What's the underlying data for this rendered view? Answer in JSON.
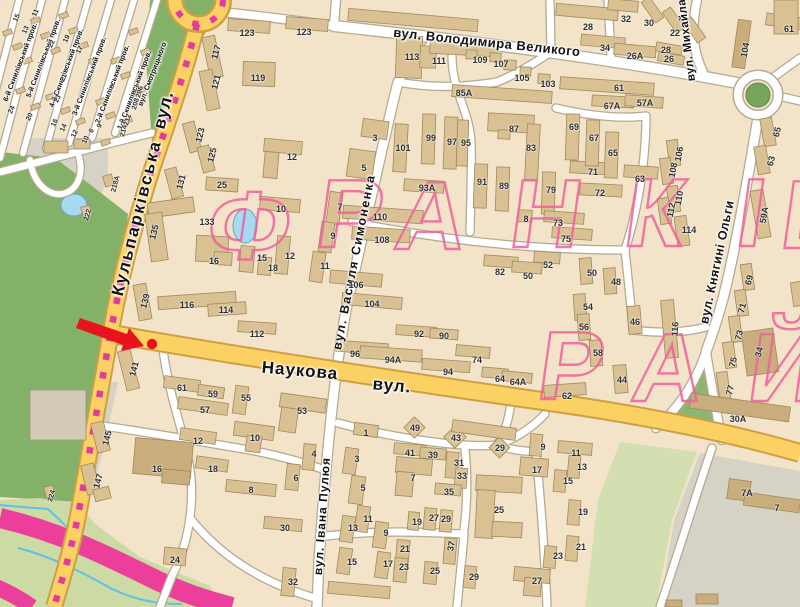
{
  "map": {
    "colors": {
      "road_yellow": "#fcd163",
      "road_yellow_casing": "#cf9f45",
      "tram_magenta": "#e23a9e",
      "district_pink": "#f0609c",
      "marker_red": "#e8131b",
      "park_green": "#83b168",
      "highway_pink": "#ec3f9c"
    },
    "watermark": {
      "letters": [
        {
          "ch": "Ф",
          "x": 245,
          "y": 259
        },
        {
          "ch": "Р",
          "x": 346,
          "y": 247
        },
        {
          "ch": "А",
          "x": 427,
          "y": 249
        },
        {
          "ch": "Н",
          "x": 542,
          "y": 247
        },
        {
          "ch": "К",
          "x": 651,
          "y": 246
        },
        {
          "ch": "І",
          "x": 747,
          "y": 246
        },
        {
          "ch": "В",
          "x": 813,
          "y": 248
        },
        {
          "ch": "Р",
          "x": 567,
          "y": 399
        },
        {
          "ch": "А",
          "x": 664,
          "y": 401
        },
        {
          "ch": "Й",
          "x": 780,
          "y": 401
        }
      ]
    },
    "marker": {
      "color": "#e8131b",
      "type": "arrow-with-dot"
    },
    "streets": [
      {
        "name": "вул. Володимира Великого",
        "x": 487,
        "y": 42,
        "r": 6,
        "s": 13,
        "ls": 0.5
      },
      {
        "name": "Кульпарківська",
        "x": 137,
        "y": 218,
        "r": -76,
        "s": 17,
        "ls": 2
      },
      {
        "name": "вул.",
        "x": 164,
        "y": 110,
        "r": -76,
        "s": 17,
        "ls": 1
      },
      {
        "name": "Наукова",
        "x": 300,
        "y": 371,
        "r": 5,
        "s": 17,
        "ls": 1
      },
      {
        "name": "вул.",
        "x": 392,
        "y": 386,
        "r": 5,
        "s": 17,
        "ls": 1
      },
      {
        "name": "вул. Василя Симоненка",
        "x": 354,
        "y": 262,
        "r": -79,
        "s": 12.5,
        "ls": 1.5
      },
      {
        "name": "вул. Івана Пулюя",
        "x": 322,
        "y": 516,
        "r": -86,
        "s": 12,
        "ls": 1
      },
      {
        "name": "вул. Михайла",
        "x": 687,
        "y": 40,
        "r": -97,
        "s": 11.5,
        "ls": 0.5
      },
      {
        "name": "вул. Княгині Ольги",
        "x": 717,
        "y": 262,
        "r": -78,
        "s": 12.5,
        "ls": 0.5
      },
      {
        "name": "6-й Скнилівський пров.",
        "x": 20,
        "y": 62,
        "r": -69,
        "s": 7.2,
        "ls": 0
      },
      {
        "name": "5-й Скнилівський пров.",
        "x": 43,
        "y": 58,
        "r": -69,
        "s": 7.2,
        "ls": 0
      },
      {
        "name": "4-й Скнилівський пров.",
        "x": 66,
        "y": 68,
        "r": -69,
        "s": 7.2,
        "ls": 0
      },
      {
        "name": "3-й Скнилівський пров.",
        "x": 89,
        "y": 76,
        "r": -69,
        "s": 7.2,
        "ls": 0
      },
      {
        "name": "2-й Скнилівський пров.",
        "x": 112,
        "y": 84,
        "r": -69,
        "s": 7.2,
        "ls": 0
      },
      {
        "name": "1-й Скнилівський пров.",
        "x": 134,
        "y": 90,
        "r": -69,
        "s": 7.2,
        "ls": 0
      },
      {
        "name": "вул. Смотрицького",
        "x": 152,
        "y": 74,
        "r": -69,
        "s": 7.2,
        "ls": 0
      }
    ],
    "numbers": [
      {
        "t": "113",
        "x": 412,
        "y": 57
      },
      {
        "t": "111",
        "x": 439,
        "y": 61
      },
      {
        "t": "109",
        "x": 480,
        "y": 60
      },
      {
        "t": "107",
        "x": 501,
        "y": 64
      },
      {
        "t": "105",
        "x": 522,
        "y": 78
      },
      {
        "t": "103",
        "x": 548,
        "y": 84
      },
      {
        "t": "28",
        "x": 588,
        "y": 27
      },
      {
        "t": "32",
        "x": 626,
        "y": 19
      },
      {
        "t": "34",
        "x": 605,
        "y": 48
      },
      {
        "t": "26А",
        "x": 635,
        "y": 56
      },
      {
        "t": "30",
        "x": 649,
        "y": 23
      },
      {
        "t": "22",
        "x": 675,
        "y": 33
      },
      {
        "t": "28",
        "x": 666,
        "y": 50
      },
      {
        "t": "26",
        "x": 669,
        "y": 59
      },
      {
        "t": "104",
        "x": 745,
        "y": 50,
        "r": -80
      },
      {
        "t": "61",
        "x": 789,
        "y": 29
      },
      {
        "t": "65",
        "x": 777,
        "y": 132,
        "r": -75
      },
      {
        "t": "63",
        "x": 771,
        "y": 161,
        "r": -75
      },
      {
        "t": "85А",
        "x": 464,
        "y": 93
      },
      {
        "t": "61",
        "x": 619,
        "y": 88
      },
      {
        "t": "67А",
        "x": 612,
        "y": 106
      },
      {
        "t": "57А",
        "x": 645,
        "y": 103
      },
      {
        "t": "69",
        "x": 574,
        "y": 127
      },
      {
        "t": "67",
        "x": 594,
        "y": 138
      },
      {
        "t": "65",
        "x": 613,
        "y": 153
      },
      {
        "t": "71",
        "x": 593,
        "y": 172
      },
      {
        "t": "72",
        "x": 600,
        "y": 193
      },
      {
        "t": "79",
        "x": 551,
        "y": 190
      },
      {
        "t": "89",
        "x": 504,
        "y": 186
      },
      {
        "t": "91",
        "x": 482,
        "y": 182
      },
      {
        "t": "83",
        "x": 531,
        "y": 148
      },
      {
        "t": "87",
        "x": 514,
        "y": 129
      },
      {
        "t": "95",
        "x": 466,
        "y": 143
      },
      {
        "t": "97",
        "x": 452,
        "y": 142
      },
      {
        "t": "99",
        "x": 431,
        "y": 138
      },
      {
        "t": "101",
        "x": 403,
        "y": 148
      },
      {
        "t": "93А",
        "x": 427,
        "y": 188
      },
      {
        "t": "8",
        "x": 526,
        "y": 219
      },
      {
        "t": "117",
        "x": 216,
        "y": 52,
        "r": -75
      },
      {
        "t": "119",
        "x": 258,
        "y": 78
      },
      {
        "t": "121",
        "x": 216,
        "y": 82,
        "r": -75
      },
      {
        "t": "123",
        "x": 247,
        "y": 33
      },
      {
        "t": "123",
        "x": 304,
        "y": 32
      },
      {
        "t": "123",
        "x": 200,
        "y": 135,
        "r": -75
      },
      {
        "t": "125",
        "x": 212,
        "y": 155,
        "r": -75
      },
      {
        "t": "131",
        "x": 181,
        "y": 182,
        "r": -75
      },
      {
        "t": "135",
        "x": 154,
        "y": 232,
        "r": -75
      },
      {
        "t": "16",
        "x": 214,
        "y": 261
      },
      {
        "t": "133",
        "x": 207,
        "y": 222
      },
      {
        "t": "139",
        "x": 145,
        "y": 301,
        "r": -75
      },
      {
        "t": "116",
        "x": 187,
        "y": 305
      },
      {
        "t": "114",
        "x": 226,
        "y": 310
      },
      {
        "t": "206",
        "x": 140,
        "y": 92,
        "r": -75,
        "s": 7
      },
      {
        "t": "208",
        "x": 136,
        "y": 104,
        "r": -75,
        "s": 7
      },
      {
        "t": "212",
        "x": 128,
        "y": 120,
        "r": -75,
        "s": 7
      },
      {
        "t": "214",
        "x": 124,
        "y": 131,
        "r": -75,
        "s": 7
      },
      {
        "t": "218А",
        "x": 116,
        "y": 184,
        "r": -75,
        "s": 7
      },
      {
        "t": "222",
        "x": 88,
        "y": 215,
        "r": -75,
        "s": 7
      },
      {
        "t": "224",
        "x": 52,
        "y": 496,
        "r": -75,
        "s": 7
      },
      {
        "t": "25",
        "x": 222,
        "y": 185
      },
      {
        "t": "12",
        "x": 292,
        "y": 157
      },
      {
        "t": "10",
        "x": 281,
        "y": 209
      },
      {
        "t": "12",
        "x": 290,
        "y": 256
      },
      {
        "t": "15",
        "x": 262,
        "y": 258
      },
      {
        "t": "18",
        "x": 273,
        "y": 268
      },
      {
        "t": "3",
        "x": 375,
        "y": 138
      },
      {
        "t": "5",
        "x": 364,
        "y": 168
      },
      {
        "t": "7",
        "x": 340,
        "y": 207
      },
      {
        "t": "9",
        "x": 333,
        "y": 236
      },
      {
        "t": "11",
        "x": 325,
        "y": 266
      },
      {
        "t": "110",
        "x": 380,
        "y": 217
      },
      {
        "t": "108",
        "x": 382,
        "y": 240
      },
      {
        "t": "106",
        "x": 356,
        "y": 285
      },
      {
        "t": "104",
        "x": 372,
        "y": 304
      },
      {
        "t": "112",
        "x": 257,
        "y": 334
      },
      {
        "t": "96",
        "x": 355,
        "y": 354
      },
      {
        "t": "94А",
        "x": 393,
        "y": 360
      },
      {
        "t": "94",
        "x": 448,
        "y": 372
      },
      {
        "t": "92",
        "x": 419,
        "y": 334
      },
      {
        "t": "90",
        "x": 444,
        "y": 336
      },
      {
        "t": "74",
        "x": 477,
        "y": 360
      },
      {
        "t": "82",
        "x": 500,
        "y": 272
      },
      {
        "t": "52",
        "x": 548,
        "y": 265
      },
      {
        "t": "50",
        "x": 528,
        "y": 276
      },
      {
        "t": "64",
        "x": 500,
        "y": 379
      },
      {
        "t": "64А",
        "x": 518,
        "y": 382
      },
      {
        "t": "62",
        "x": 567,
        "y": 396
      },
      {
        "t": "63",
        "x": 640,
        "y": 179
      },
      {
        "t": "106",
        "x": 679,
        "y": 154,
        "r": -80
      },
      {
        "t": "108",
        "x": 673,
        "y": 170,
        "r": -80
      },
      {
        "t": "110",
        "x": 679,
        "y": 198,
        "r": -80
      },
      {
        "t": "112",
        "x": 671,
        "y": 210,
        "r": -80
      },
      {
        "t": "114",
        "x": 689,
        "y": 230
      },
      {
        "t": "59А",
        "x": 764,
        "y": 215,
        "r": -80
      },
      {
        "t": "50",
        "x": 592,
        "y": 273
      },
      {
        "t": "48",
        "x": 616,
        "y": 282
      },
      {
        "t": "54",
        "x": 588,
        "y": 307
      },
      {
        "t": "56",
        "x": 584,
        "y": 327
      },
      {
        "t": "58",
        "x": 598,
        "y": 353
      },
      {
        "t": "46",
        "x": 635,
        "y": 322
      },
      {
        "t": "44",
        "x": 622,
        "y": 380
      },
      {
        "t": "116",
        "x": 675,
        "y": 329,
        "r": -85
      },
      {
        "t": "73",
        "x": 558,
        "y": 223
      },
      {
        "t": "75",
        "x": 566,
        "y": 239
      },
      {
        "t": "69",
        "x": 749,
        "y": 280,
        "r": -75
      },
      {
        "t": "71",
        "x": 742,
        "y": 308,
        "r": -75
      },
      {
        "t": "73",
        "x": 739,
        "y": 335,
        "r": -75
      },
      {
        "t": "75",
        "x": 733,
        "y": 362,
        "r": -75
      },
      {
        "t": "77",
        "x": 730,
        "y": 390,
        "r": -75
      },
      {
        "t": "34",
        "x": 759,
        "y": 352,
        "r": -75
      },
      {
        "t": "30А",
        "x": 738,
        "y": 419
      },
      {
        "t": "7А",
        "x": 747,
        "y": 493
      },
      {
        "t": "7",
        "x": 777,
        "y": 508
      },
      {
        "t": "141",
        "x": 134,
        "y": 369,
        "r": -75
      },
      {
        "t": "145",
        "x": 107,
        "y": 438,
        "r": -75
      },
      {
        "t": "147",
        "x": 98,
        "y": 481,
        "r": -75
      },
      {
        "t": "61",
        "x": 182,
        "y": 388
      },
      {
        "t": "59",
        "x": 213,
        "y": 394
      },
      {
        "t": "57",
        "x": 205,
        "y": 410
      },
      {
        "t": "55",
        "x": 246,
        "y": 398
      },
      {
        "t": "53",
        "x": 302,
        "y": 411
      },
      {
        "t": "12",
        "x": 198,
        "y": 441
      },
      {
        "t": "10",
        "x": 255,
        "y": 438
      },
      {
        "t": "18",
        "x": 213,
        "y": 469
      },
      {
        "t": "16",
        "x": 157,
        "y": 469
      },
      {
        "t": "8",
        "x": 251,
        "y": 490
      },
      {
        "t": "6",
        "x": 296,
        "y": 478
      },
      {
        "t": "24",
        "x": 175,
        "y": 560
      },
      {
        "t": "30",
        "x": 285,
        "y": 528
      },
      {
        "t": "32",
        "x": 293,
        "y": 582
      },
      {
        "t": "1",
        "x": 366,
        "y": 433
      },
      {
        "t": "3",
        "x": 357,
        "y": 459
      },
      {
        "t": "4",
        "x": 314,
        "y": 454
      },
      {
        "t": "5",
        "x": 363,
        "y": 488
      },
      {
        "t": "7",
        "x": 413,
        "y": 478
      },
      {
        "t": "41",
        "x": 410,
        "y": 453
      },
      {
        "t": "39",
        "x": 433,
        "y": 455
      },
      {
        "t": "43",
        "x": 456,
        "y": 438
      },
      {
        "t": "49",
        "x": 415,
        "y": 428
      },
      {
        "t": "29",
        "x": 500,
        "y": 448
      },
      {
        "t": "31",
        "x": 459,
        "y": 463
      },
      {
        "t": "33",
        "x": 462,
        "y": 476
      },
      {
        "t": "35",
        "x": 449,
        "y": 492
      },
      {
        "t": "37",
        "x": 451,
        "y": 546,
        "r": -80
      },
      {
        "t": "11",
        "x": 368,
        "y": 519
      },
      {
        "t": "13",
        "x": 353,
        "y": 528
      },
      {
        "t": "9",
        "x": 386,
        "y": 533
      },
      {
        "t": "15",
        "x": 352,
        "y": 562
      },
      {
        "t": "17",
        "x": 388,
        "y": 564
      },
      {
        "t": "19",
        "x": 417,
        "y": 522
      },
      {
        "t": "27",
        "x": 434,
        "y": 518
      },
      {
        "t": "29",
        "x": 446,
        "y": 519
      },
      {
        "t": "21",
        "x": 405,
        "y": 549
      },
      {
        "t": "23",
        "x": 404,
        "y": 567
      },
      {
        "t": "25",
        "x": 435,
        "y": 571
      },
      {
        "t": "25",
        "x": 499,
        "y": 510
      },
      {
        "t": "9",
        "x": 543,
        "y": 447
      },
      {
        "t": "11",
        "x": 576,
        "y": 453
      },
      {
        "t": "13",
        "x": 582,
        "y": 467
      },
      {
        "t": "17",
        "x": 537,
        "y": 470
      },
      {
        "t": "15",
        "x": 568,
        "y": 481
      },
      {
        "t": "19",
        "x": 583,
        "y": 512
      },
      {
        "t": "21",
        "x": 581,
        "y": 547
      },
      {
        "t": "23",
        "x": 558,
        "y": 556
      },
      {
        "t": "27",
        "x": 537,
        "y": 581
      },
      {
        "t": "29",
        "x": 474,
        "y": 577
      },
      {
        "t": "15",
        "x": 17,
        "y": 18,
        "r": -65,
        "s": 7
      },
      {
        "t": "13",
        "x": 26,
        "y": 30,
        "r": -65,
        "s": 7
      },
      {
        "t": "11",
        "x": 36,
        "y": 13,
        "r": -65,
        "s": 7
      },
      {
        "t": "19",
        "x": 67,
        "y": 39,
        "r": -65,
        "s": 7
      },
      {
        "t": "22",
        "x": 52,
        "y": 44,
        "r": -65,
        "s": 7
      },
      {
        "t": "21",
        "x": 64,
        "y": 78,
        "r": -65,
        "s": 7
      },
      {
        "t": "23",
        "x": 58,
        "y": 99,
        "r": -65,
        "s": 7
      },
      {
        "t": "24",
        "x": 12,
        "y": 110,
        "r": -65,
        "s": 7
      },
      {
        "t": "20",
        "x": 30,
        "y": 117,
        "r": -65,
        "s": 7
      },
      {
        "t": "17",
        "x": 80,
        "y": 50,
        "r": -65,
        "s": 7
      },
      {
        "t": "16",
        "x": 55,
        "y": 123,
        "r": -65,
        "s": 7
      },
      {
        "t": "14",
        "x": 64,
        "y": 128,
        "r": -65,
        "s": 7
      },
      {
        "t": "12",
        "x": 75,
        "y": 134,
        "r": -65,
        "s": 7
      },
      {
        "t": "10",
        "x": 86,
        "y": 140,
        "r": -65,
        "s": 7
      },
      {
        "t": "9",
        "x": 100,
        "y": 126,
        "r": -65,
        "s": 7
      },
      {
        "t": "6",
        "x": 92,
        "y": 131,
        "r": -65,
        "s": 7
      }
    ]
  }
}
